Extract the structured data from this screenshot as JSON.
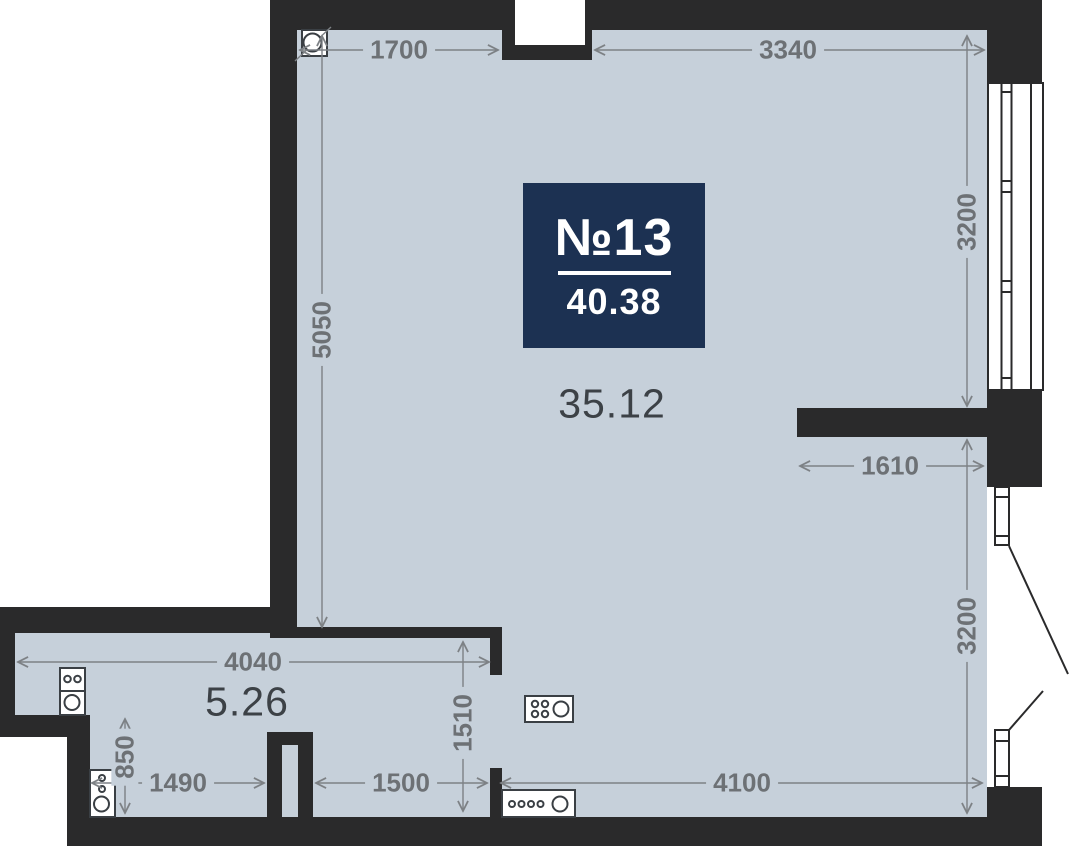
{
  "plan": {
    "badge": {
      "unit_label": "№13",
      "total_area": "40.38"
    },
    "areas": {
      "main_room": "35.12",
      "kitchen": "5.26"
    },
    "dims": {
      "d1700": "1700",
      "d3340": "3340",
      "d5050": "5050",
      "d3200_top": "3200",
      "d1610": "1610",
      "d3200_bottom": "3200",
      "d4040": "4040",
      "d1510": "1510",
      "d850": "850",
      "d1490": "1490",
      "d1500": "1500",
      "d4100": "4100"
    },
    "icons": [
      "pipe-riser-icon",
      "stove-icon",
      "sink-icon",
      "washer-icon",
      "hob-icon",
      "counter-sink-icon",
      "window-icon",
      "balcony-door-icon"
    ],
    "colors": {
      "wall": "#2a2a2b",
      "floor": "#c6d0da",
      "badge_bg": "#1c3152",
      "dim_text": "#6d7175",
      "dim_line": "#7d8185",
      "area_text": "#3c4146",
      "icon_stroke": "#3a3f44",
      "white": "#ffffff"
    }
  }
}
